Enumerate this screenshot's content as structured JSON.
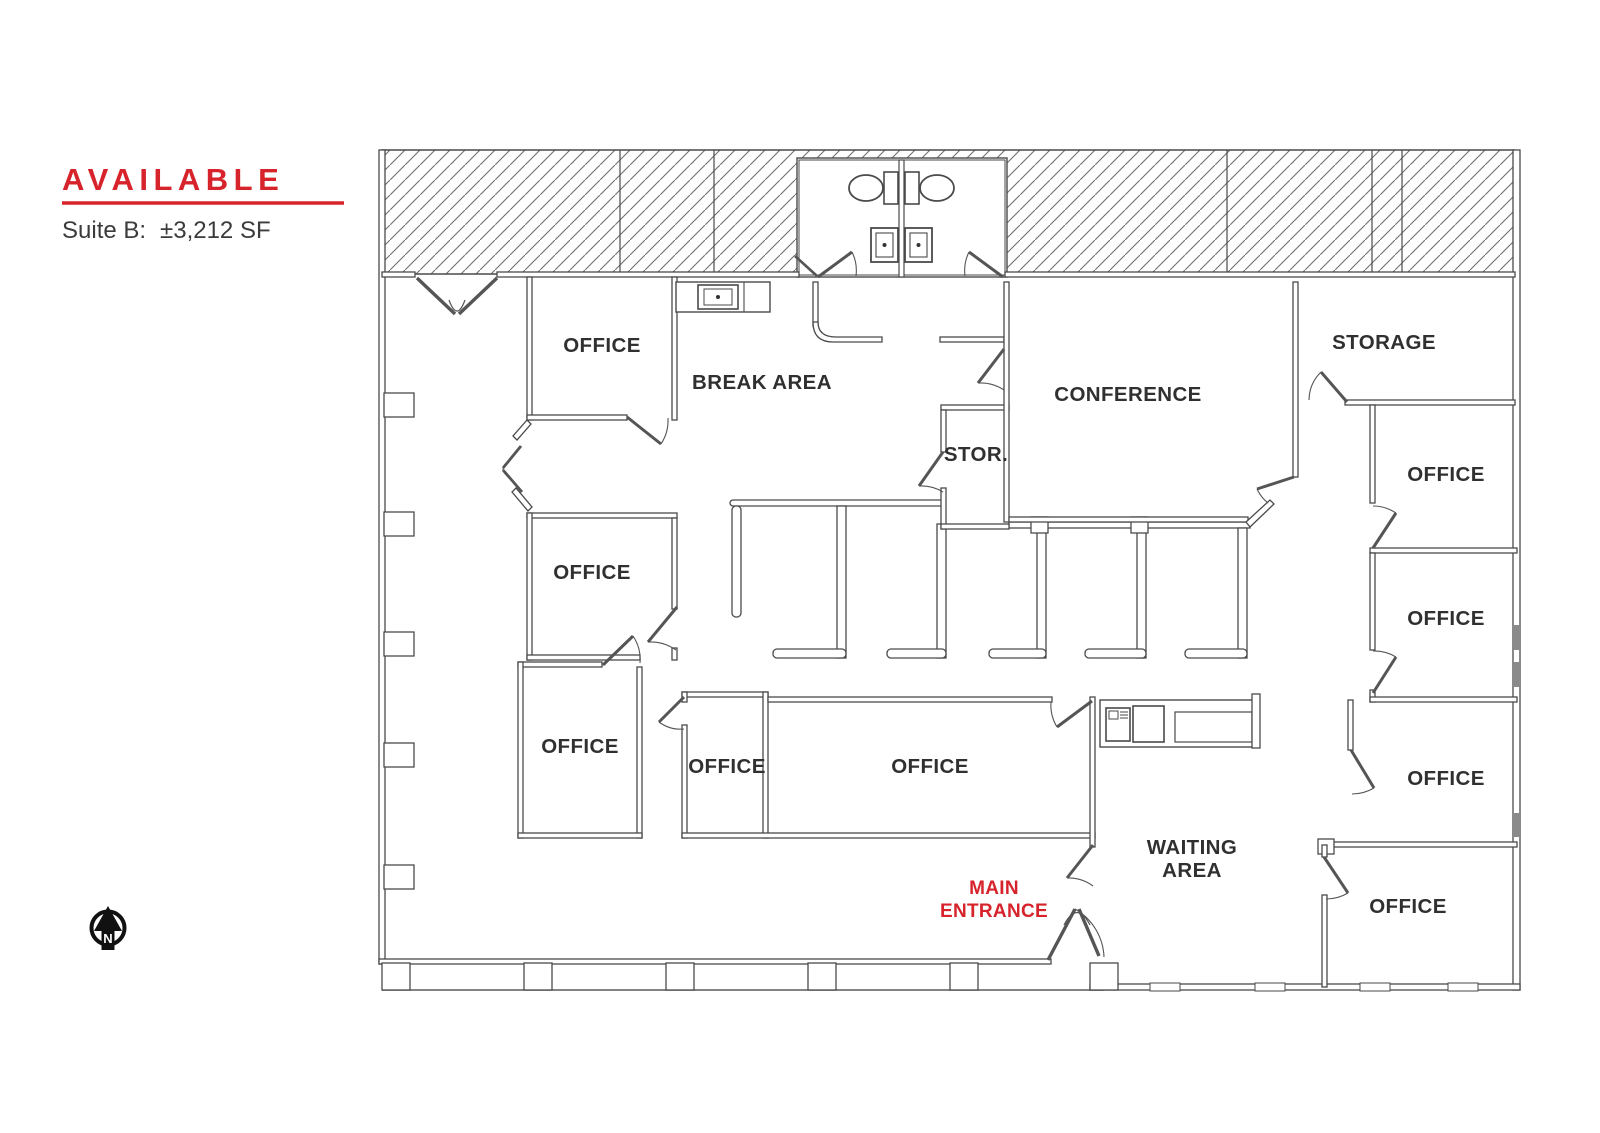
{
  "accent_color": "#d7232b",
  "legend": {
    "title": "AVAILABLE",
    "suite_label": "Suite B:",
    "suite_value": "±3,212 SF"
  },
  "north": {
    "label": "N"
  },
  "rooms": [
    {
      "id": "office-top-left",
      "label": "OFFICE"
    },
    {
      "id": "break-area",
      "label": "BREAK AREA"
    },
    {
      "id": "conference",
      "label": "CONFERENCE"
    },
    {
      "id": "storage",
      "label": "STORAGE"
    },
    {
      "id": "storage-small",
      "label": "STOR."
    },
    {
      "id": "office-right-1",
      "label": "OFFICE"
    },
    {
      "id": "office-left-middle",
      "label": "OFFICE"
    },
    {
      "id": "office-right-2",
      "label": "OFFICE"
    },
    {
      "id": "office-left-lower",
      "label": "OFFICE"
    },
    {
      "id": "office-bottom-small",
      "label": "OFFICE"
    },
    {
      "id": "office-bottom-wide",
      "label": "OFFICE"
    },
    {
      "id": "office-right-3",
      "label": "OFFICE"
    },
    {
      "id": "office-bottom-right",
      "label": "OFFICE"
    }
  ],
  "waiting_area": {
    "line1": "WAITING",
    "line2": "AREA"
  },
  "entrance": {
    "line1": "MAIN",
    "line2": "ENTRANCE"
  }
}
